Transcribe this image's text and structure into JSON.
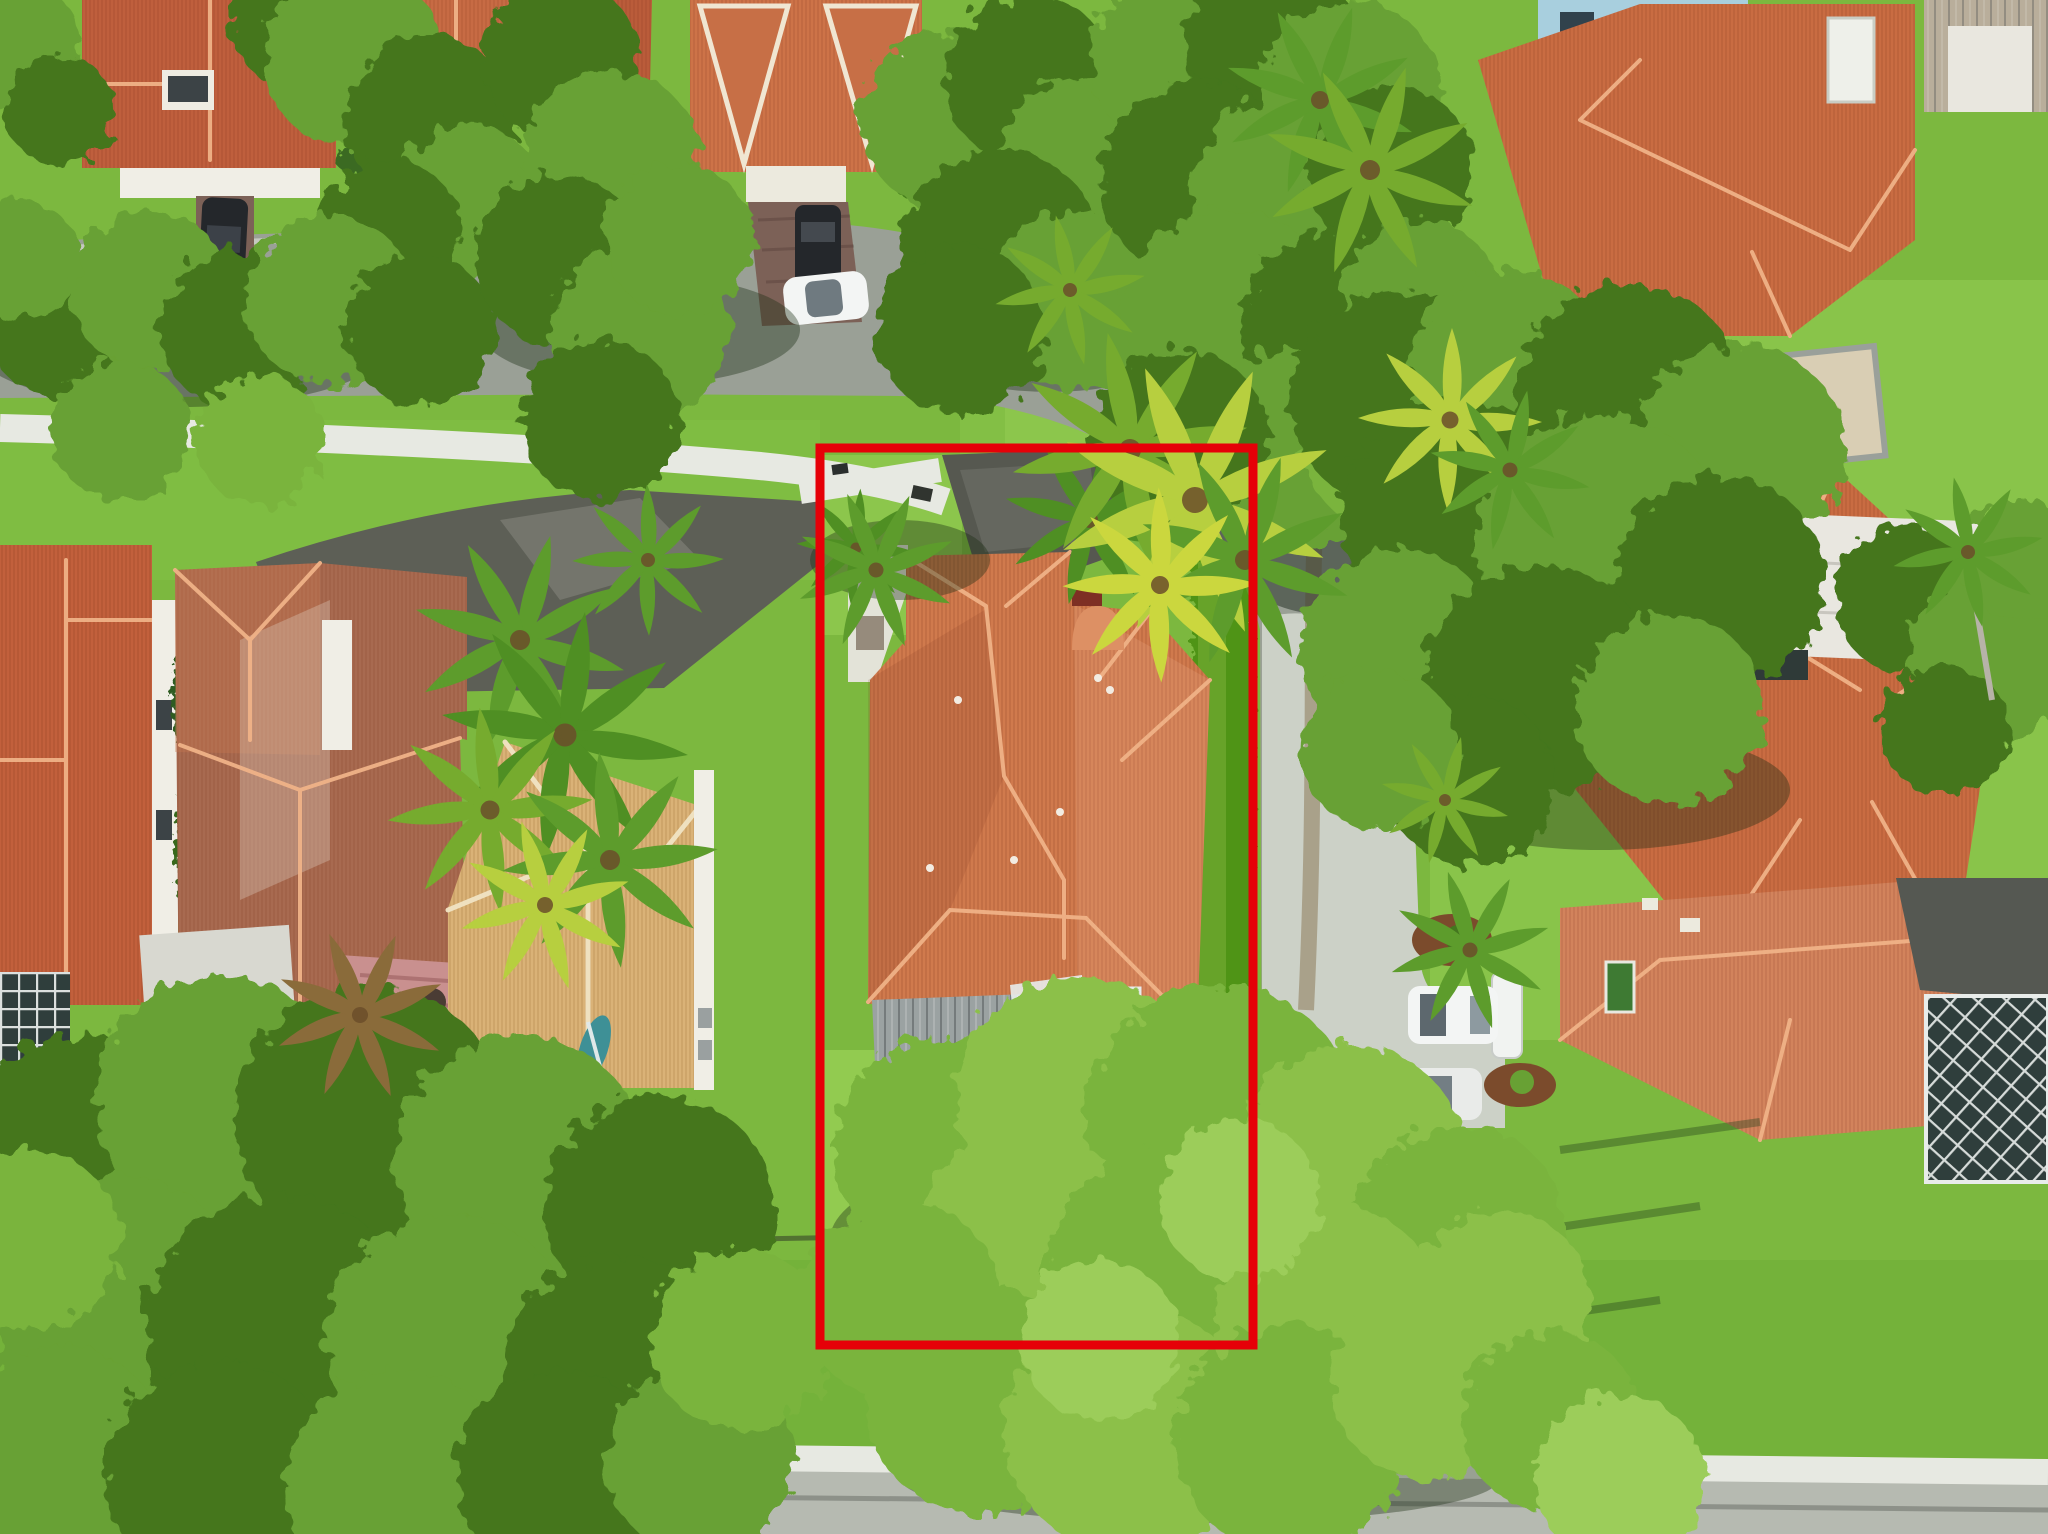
{
  "meta": {
    "type": "aerial-drone-photo",
    "description": "Aerial drone photo of a suburban Florida neighborhood; the subject single-family home lot with terracotta tile roof, screened patio and deep green backyard is outlined with a red property-boundary rectangle, surrounded by neighboring tile-roof houses, curving streets, sidewalks, lawns, palms and large tree canopies."
  },
  "annotation": {
    "label": "property-boundary",
    "x": 820,
    "y": 448,
    "width": 433,
    "height": 897,
    "color": "#e60008",
    "stroke_width": 9
  },
  "palette": {
    "lawn": "#7cb83f",
    "lawn_bright": "#92cb50",
    "lawn_shade": "#4e8026",
    "canopy_light": "#8cc04a",
    "canopy_mid": "#68a134",
    "canopy_dark": "#44761f",
    "hedge": "#509417",
    "road_asphalt": "#9aa096",
    "road_concrete": "#ccd1c7",
    "road_bottom": "#b6bab1",
    "sidewalk": "#e7e9e2",
    "roof_subject": "#d07a4d",
    "roof_terracotta": "#c96c42",
    "roof_brown": "#a86a50",
    "roof_tan": "#dab277",
    "roof_salmon": "#d2835c",
    "roof_gray_wood": "#9ba2a2",
    "screen_enclosure": "#2f3e3c",
    "deck_pink": "#c9908f",
    "wall_white": "#f0eee6",
    "wall_blue": "#a8cfde",
    "driveway_dark": "#5d5f56",
    "paver_brown": "#7c6157",
    "car_dark": "#24272b",
    "car_white": "#f3f5f4",
    "stain_brown": "#8c7a57",
    "kayak_teal": "#3e9096",
    "boundary_red": "#e60008"
  },
  "objects": [
    {
      "name": "property-boundary",
      "type": "annotation",
      "desc": "red rectangle outlining subject lot"
    },
    {
      "name": "subject-house",
      "type": "house",
      "desc": "terracotta tile hip roof, front driveway and walkway"
    },
    {
      "name": "subject-gray-roof-section",
      "type": "roof",
      "desc": "weathered gray wood flat roof at rear"
    },
    {
      "name": "subject-pool-screen",
      "type": "screen-enclosure",
      "desc": "dark screened patio with white frame"
    },
    {
      "name": "subject-backyard",
      "type": "lawn",
      "desc": "large green backyard with fence line"
    },
    {
      "name": "boundary-hedge",
      "type": "hedge",
      "desc": "tall hedge along east lot line"
    },
    {
      "name": "street-upper",
      "type": "road",
      "desc": "asphalt street curving from left to the right side"
    },
    {
      "name": "street-right",
      "type": "road",
      "desc": "concrete lane running south along lot with brown stain"
    },
    {
      "name": "street-bottom",
      "type": "road",
      "desc": "street with sidewalk along bottom edge"
    },
    {
      "name": "sidewalks",
      "type": "path",
      "desc": "white concrete sidewalks"
    },
    {
      "name": "left-house-a",
      "type": "house",
      "desc": "orange tile roof at far left"
    },
    {
      "name": "left-house-b",
      "type": "house",
      "desc": "brown cross-hip roof house with pink rear deck"
    },
    {
      "name": "left-house-c",
      "type": "house",
      "desc": "tan tile roof house next to subject lot"
    },
    {
      "name": "top-left-houses",
      "type": "houses",
      "desc": "tile roofs along upper street with gabled house"
    },
    {
      "name": "top-right-house",
      "type": "house",
      "desc": "large terracotta roof with blue two-story walls"
    },
    {
      "name": "right-middle-house",
      "type": "house",
      "desc": "terracotta roof with white patio cover"
    },
    {
      "name": "bottom-right-house",
      "type": "house",
      "desc": "salmon tile roof with pool screen enclosure"
    },
    {
      "name": "pickup-truck",
      "type": "vehicle",
      "desc": "dark pickup in top-left driveway"
    },
    {
      "name": "sedan-left-street",
      "type": "vehicle",
      "desc": "dark sedan parked at left street edge"
    },
    {
      "name": "black-suv",
      "type": "vehicle",
      "desc": "black SUV on paver driveway top-center"
    },
    {
      "name": "white-hatchback",
      "type": "vehicle",
      "desc": "white car behind black SUV"
    },
    {
      "name": "white-suv-right",
      "type": "vehicle",
      "desc": "white SUV on right parking pad"
    },
    {
      "name": "white-car-right",
      "type": "vehicle",
      "desc": "second white car on right parking pad"
    },
    {
      "name": "kayak",
      "type": "object",
      "desc": "teal paddle craft on left lawn"
    },
    {
      "name": "stop-sign-back",
      "type": "object",
      "desc": "round sign on post at road curve"
    },
    {
      "name": "tree-canopies",
      "type": "vegetation",
      "desc": "large oak canopies top-center, right and bottom"
    },
    {
      "name": "palm-trees",
      "type": "vegetation",
      "desc": "palms around houses and lot corners"
    }
  ]
}
